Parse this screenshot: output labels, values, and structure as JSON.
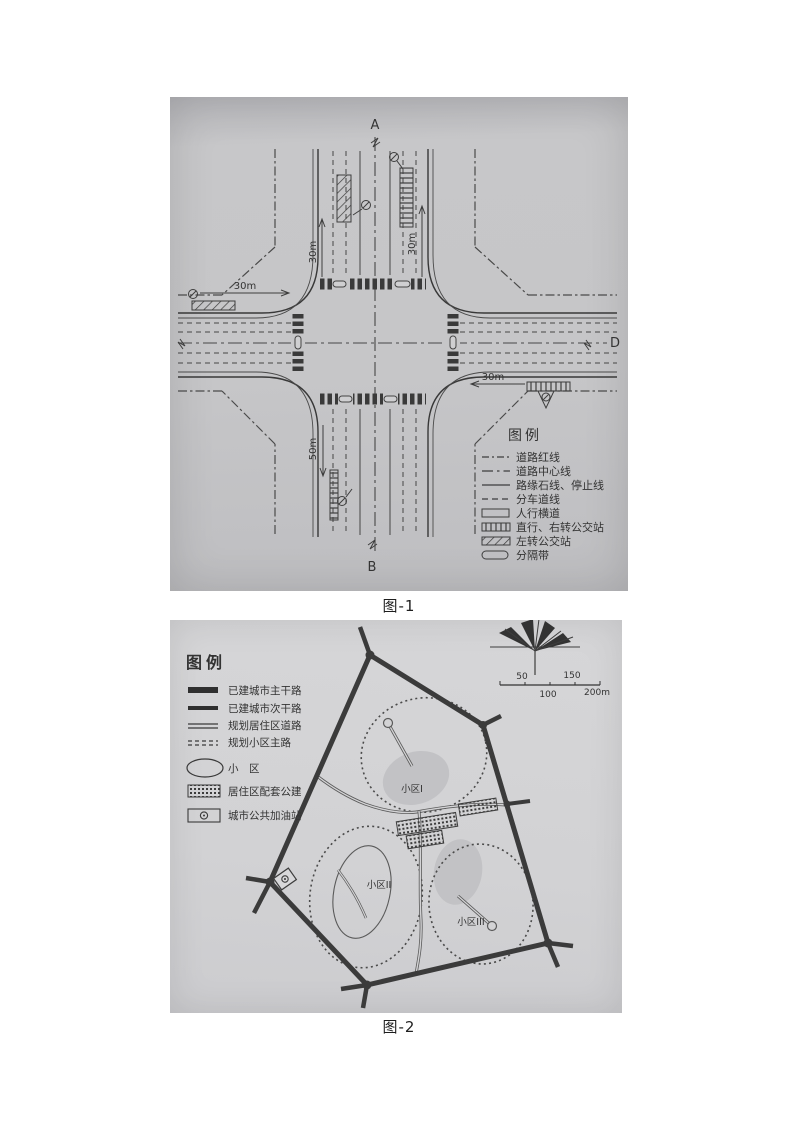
{
  "colors": {
    "ink": "#3d3d3d",
    "figure1_background": "#c6c6c8",
    "figure2_background": "#d3d3d5"
  },
  "figure1": {
    "caption": "图-1",
    "markers": {
      "top": "A",
      "bottom": "B",
      "right": "D"
    },
    "dimensions": {
      "top_left": "30m",
      "top_right": "30m",
      "left": "30m",
      "right": "30m",
      "bottom": "50m"
    },
    "legend": {
      "title": "图例",
      "items": [
        {
          "label": "道路红线",
          "symbol": "dash-dot-line"
        },
        {
          "label": "道路中心线",
          "symbol": "center-dash-dot-line"
        },
        {
          "label": "路缘石线、停止线",
          "symbol": "solid-line"
        },
        {
          "label": "分车道线",
          "symbol": "dashed-line"
        },
        {
          "label": "人行横道",
          "symbol": "crosswalk-rect"
        },
        {
          "label": "直行、右转公交站",
          "symbol": "vertical-hatch-rect"
        },
        {
          "label": "左转公交站",
          "symbol": "diagonal-hatch-rect"
        },
        {
          "label": "分隔带",
          "symbol": "capsule"
        }
      ]
    }
  },
  "figure2": {
    "caption": "图-2",
    "legend": {
      "title": "图例",
      "items": [
        {
          "label": "已建城市主干路",
          "symbol": "thick-solid-bar"
        },
        {
          "label": "已建城市次干路",
          "symbol": "medium-solid-bar"
        },
        {
          "label": "规划居住区道路",
          "symbol": "double-line"
        },
        {
          "label": "规划小区主路",
          "symbol": "dashed-double-line"
        },
        {
          "label": "小　区",
          "symbol": "ellipse"
        },
        {
          "label": "居住区配套公建",
          "symbol": "hatched-rect"
        },
        {
          "label": "城市公共加油站",
          "symbol": "gas-station-rect"
        }
      ]
    },
    "scale_bar": {
      "above": [
        "50",
        "150"
      ],
      "below": [
        "100",
        "200m"
      ]
    },
    "districts": [
      "小区I",
      "小区II",
      "小区III"
    ]
  }
}
